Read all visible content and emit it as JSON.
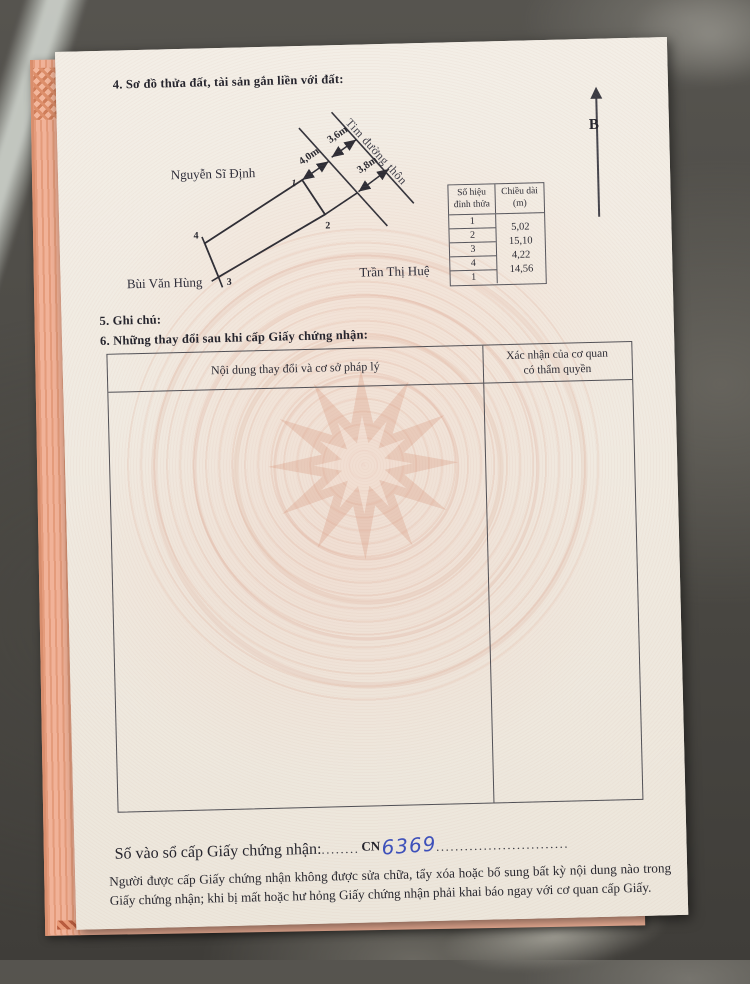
{
  "page": {
    "section4_title": "4. Sơ đồ thửa đất, tài sản gắn liền với đất:",
    "section5_title": "5. Ghi chú:",
    "section6_title": "6. Những thay đổi sau khi cấp Giấy chứng nhận:",
    "north_label": "B",
    "footer_note": "Người được cấp Giấy chứng nhận không được sửa chữa, tẩy xóa hoặc bổ sung bất kỳ nội dung nào trong Giấy chứng nhận; khi bị mất hoặc hư hỏng Giấy chứng nhận phải khai báo ngay với cơ quan cấp Giấy."
  },
  "registry": {
    "label": "Số vào sổ cấp Giấy chứng nhận:",
    "dots_before": "........",
    "prefix": "CN",
    "number": "6369",
    "dots_after": "............................"
  },
  "diagram": {
    "road_label": "Tim đường thôn",
    "neighbor_top_left": "Nguyễn Sĩ Định",
    "neighbor_bottom_left": "Bùi Văn Hùng",
    "neighbor_bottom_right": "Trần Thị Huệ",
    "dim_front": "4,0m",
    "dim_to_center": "3,6m",
    "dim_side": "3,8m",
    "vertex_1": "1",
    "vertex_2": "2",
    "vertex_3": "3",
    "vertex_4": "4"
  },
  "vertex_table": {
    "header_col1_line1": "Số hiệu",
    "header_col1_line2": "đỉnh thửa",
    "header_col2_line1": "Chiều dài",
    "header_col2_line2": "(m)",
    "rows": [
      "1",
      "2",
      "3",
      "4",
      "1"
    ],
    "lengths": [
      "5,02",
      "15,10",
      "4,22",
      "14,56"
    ]
  },
  "changes_table": {
    "col1_header": "Nội dung thay đổi và cơ sở pháp lý",
    "col2_header_line1": "Xác nhận của cơ quan",
    "col2_header_line2": "có thẩm quyền"
  },
  "colors": {
    "handwriting_blue": "#3b4fbb",
    "paper": "#f1ebe2",
    "under_page_pink": "#f1b298",
    "marble_gray": "#4e4c47"
  }
}
